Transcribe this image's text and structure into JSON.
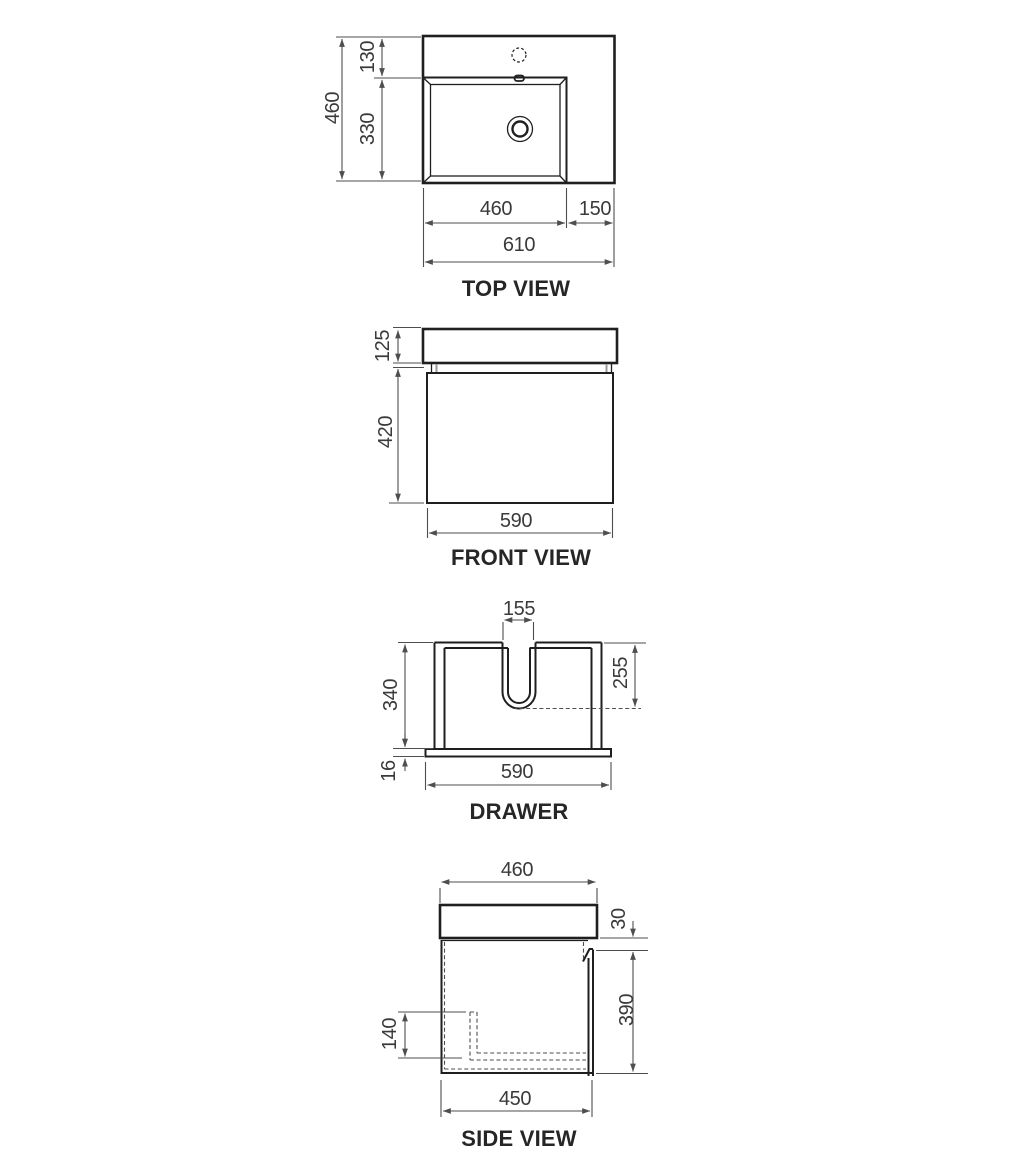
{
  "views": {
    "top": {
      "title": "TOP VIEW",
      "dims": {
        "overall_depth": "460",
        "tap_ledge_depth": "130",
        "basin_depth": "330",
        "basin_width": "460",
        "side_ledge_width": "150",
        "overall_width": "610"
      }
    },
    "front": {
      "title": "FRONT VIEW",
      "dims": {
        "benchtop_height": "125",
        "cabinet_height": "420",
        "cabinet_width": "590"
      }
    },
    "drawer": {
      "title": "DRAWER",
      "dims": {
        "cutout_width": "155",
        "drawer_height": "340",
        "cutout_depth": "255",
        "base_thickness": "16",
        "drawer_width": "590"
      }
    },
    "side": {
      "title": "SIDE VIEW",
      "dims": {
        "benchtop_depth": "460",
        "top_reveal": "30",
        "front_panel_height": "390",
        "recess_height": "140",
        "cabinet_depth": "450"
      }
    }
  },
  "colors": {
    "line": "#1f1f1f",
    "dim": "#4e4e4e",
    "text": "#3a3a3a",
    "title": "#262626",
    "background": "#ffffff"
  }
}
